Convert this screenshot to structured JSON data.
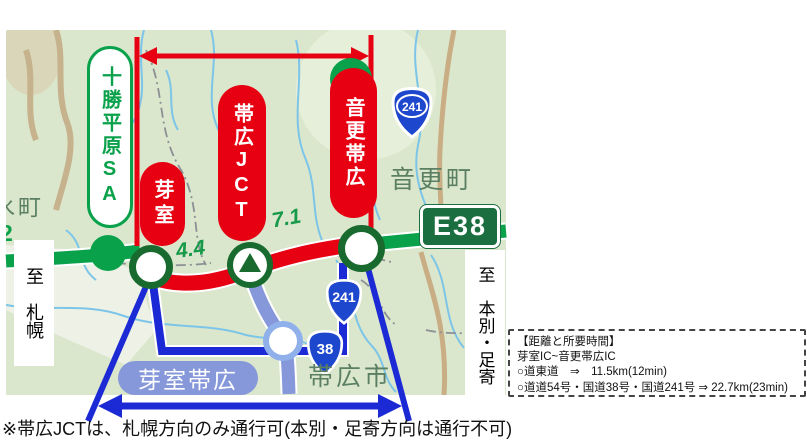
{
  "map": {
    "sa_label": "十勝平原SA",
    "sa_symbol": "A",
    "pills": {
      "memuro": "芽室",
      "obihiro_jct": "帯広JCT",
      "otofuke_obihiro": "音更帯広"
    },
    "distances": {
      "memuro_to_jct": "4.4",
      "jct_to_otofuke": "7.1",
      "edge_partial_number": "2"
    },
    "shields": {
      "expressway": "E38",
      "route241": "241",
      "route38": "38"
    },
    "towns": {
      "edge_partial_town": "水町",
      "otofuke_town": "音更町",
      "obihiro_city": "帯広市",
      "memuro_obihiro_area": "芽室帯広"
    },
    "directions": {
      "sapporo": "至　札幌",
      "honbetsu_ashoro": "至　本別・足寄"
    }
  },
  "info_box": {
    "title": "【距離と所要時間】",
    "section": "芽室IC~音更帯広IC",
    "expressway_route": "○道東道　⇒　11.5km(12min)",
    "local_route": "○道道54号・国道38号・国道241号 ⇒ 22.7km(23min)"
  },
  "caption": "※帯広JCTは、札幌方向のみ通行可(本別・足寄方向は通行不可)",
  "colors": {
    "highway_green": "#0aa14b",
    "closed_section_red": "#e60012",
    "national_route_blue": "#1d47cc",
    "local_road_blue": "#1b2ad4",
    "expressway_sign_green": "#1b6e3f",
    "obihiro_hiroo_road_blue": "#8698da",
    "marker_ring_green": "#186a2e"
  }
}
